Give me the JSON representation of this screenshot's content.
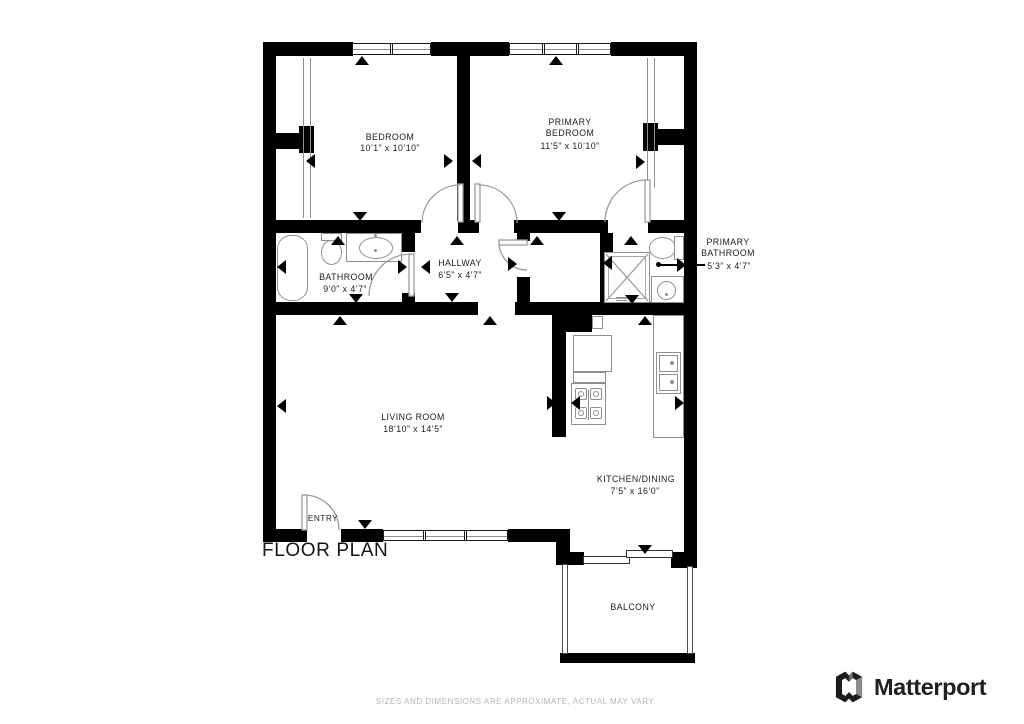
{
  "title": "FLOOR PLAN",
  "disclaimer": "SIZES AND DIMENSIONS ARE APPROXIMATE, ACTUAL MAY VARY.",
  "brand": {
    "name": "Matterport"
  },
  "colors": {
    "wall": "#000000",
    "fixture_line": "#8f8f8f",
    "text": "#1c1c1c",
    "muted": "#b4b4b4"
  },
  "rooms": {
    "bedroom": {
      "line1": "BEDROOM",
      "dims": "10’1” x 10’10”"
    },
    "primary_bedroom": {
      "line1": "PRIMARY",
      "line2": "BEDROOM",
      "dims": "11’5” x 10’10”"
    },
    "bathroom": {
      "line1": "BATHROOM",
      "dims": "9’0” x 4’7”"
    },
    "hallway": {
      "line1": "HALLWAY",
      "dims": "6’5” x 4’7”"
    },
    "primary_bathroom": {
      "line1": "PRIMARY",
      "line2": "BATHROOM",
      "dims": "5’3” x 4’7”"
    },
    "living_room": {
      "line1": "LIVING ROOM",
      "dims": "18’10” x 14’5”"
    },
    "kitchen_dining": {
      "line1": "KITCHEN/DINING",
      "dims": "7’5” x 16’0”"
    },
    "balcony": {
      "line1": "BALCONY"
    },
    "entry": {
      "line1": "ENTRY"
    }
  }
}
